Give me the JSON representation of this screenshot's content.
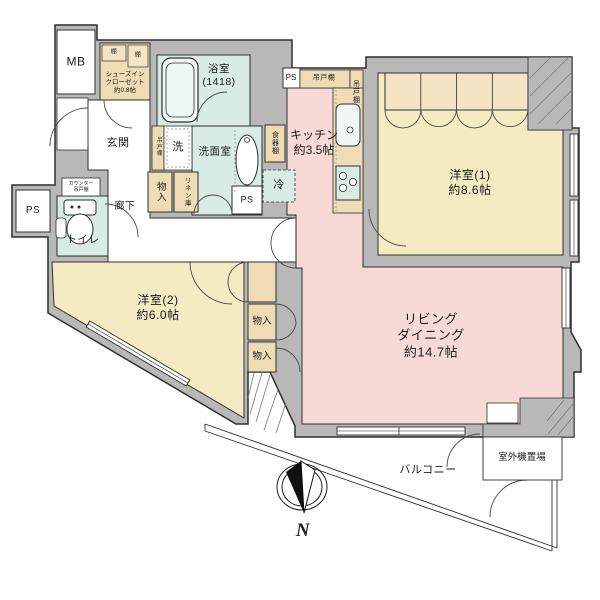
{
  "rooms": {
    "meter_box": "MB",
    "shoes_closet": "シューズイン\nクローゼット\n約0.8帖",
    "shelf_left": "棚",
    "shelf_right": "棚",
    "bathroom": "浴室\n(1418)",
    "entrance": "玄関",
    "washing_machine": "洗",
    "washer_hanging_shelf": "吊戸棚",
    "washroom": "洗面室",
    "hall_storage": "物入",
    "linen_closet": "リネン庫",
    "pipe_space_mid": "PS",
    "pipe_space_left": "PS",
    "pipe_space_top": "PS",
    "dish_shelf": "食器棚",
    "kitchen": "キッチン\n約3.5帖",
    "refrigerator": "冷",
    "hanging_shelf_top": "吊戸棚",
    "hanging_shelf_right": "吊戸棚",
    "bedroom1": "洋室(1)\n約8.6帖",
    "living_dining": "リビング\nダイニング\n約14.7帖",
    "toilet": "トイレ",
    "counter_shelf": "カウンター\n吊戸棚",
    "corridor": "廊下",
    "bedroom2": "洋室(2)\n約6.0帖",
    "storage_mid": "物入",
    "storage_low": "物入",
    "balcony": "バルコニー",
    "outdoor_unit": "室外機置場"
  },
  "compass": {
    "north": "N"
  },
  "colors": {
    "wall_gray": "#b8b8b8",
    "western_room_yellow": "#f4ebc3",
    "living_kitchen_pink": "#f7dad6",
    "wet_area_cyan": "#d8ebe5",
    "closet_tan": "#efdcb4",
    "closet_light_tan": "#f5e3c5",
    "outline": "#2f2f2f"
  }
}
